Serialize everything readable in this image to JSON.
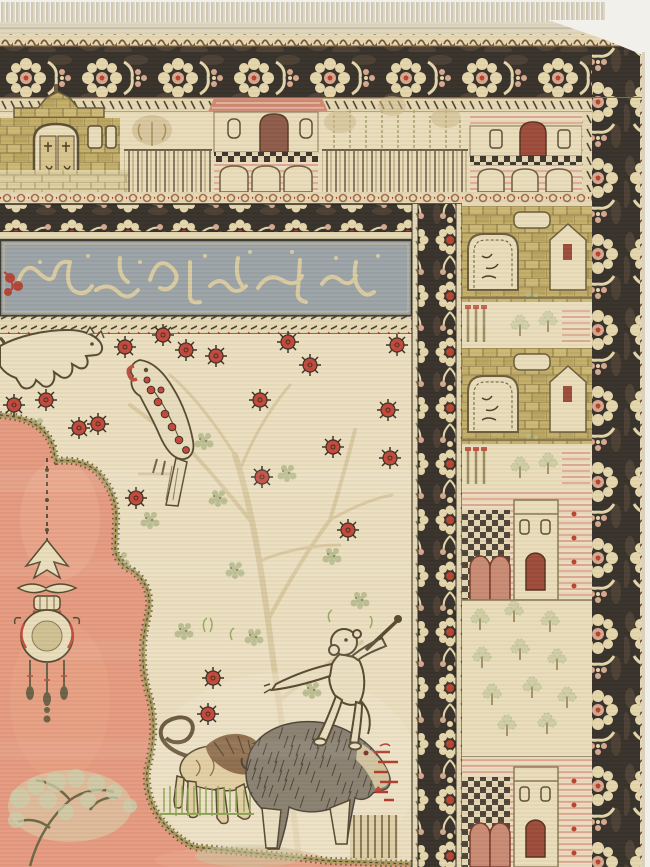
{
  "image_type": "photograph",
  "subject": "Antique Anatolian pictorial prayer rug, upper-right corner view: knotted fringe, charcoal palmette borders, architectural friezes of buildings, slate-grey calligraphic cartouche, and an ivory field with tree of life, red blossoms, salmon medallion with hanging mosque lamp, lion, shaggy boar, club-wielding monkey, perched parrot and leaping feline",
  "palette": {
    "photo_bg": "#f2f0ea",
    "fringe": "#cdc4aa",
    "kilim": "#ded6c0",
    "guard_cream": "#e6d9b4",
    "border_ground": "#35302a",
    "border_mottle": "#6b5640",
    "border_palmette": "#e6d7ac",
    "border_pink": "#d8a88c",
    "border_red": "#b8432f",
    "panel": "#e9ddbb",
    "stone": "#c3ad68",
    "stone_line": "#8a7a4a",
    "roof_pink": "#d08b74",
    "door_brown": "#8d5a49",
    "door_red": "#9c4a38",
    "inscription_ground": "#9ba3a7",
    "inscription_scroll": "#d9cba1",
    "inscription_red": "#b5392c",
    "field": "#ecdfc0",
    "branch": "#cdb88a",
    "leaf": "#b4b98b",
    "blossom": "#c4473a",
    "blossom_outline": "#3c2f24",
    "medallion": "#e59a7f",
    "medallion_edge": "#ab9b5e",
    "lamp_cream": "#e9ddba",
    "lamp_inner": "#cfc192",
    "lamp_red": "#c14c3c",
    "lion_body": "#e2cfa4",
    "lion_mane": "#8a6848",
    "boar_fur": "#8b8172",
    "bristle": "#4c443a",
    "monkey": "#ebdfc2",
    "outline": "#55492f",
    "grass": "#8fa458",
    "signature_red": "#b23a2c"
  },
  "scene": {
    "fringe": {
      "label": "warp-end fringe along top edge"
    },
    "kilim_band": {
      "label": "flatwoven end band"
    },
    "borders": {
      "outer_floral": {
        "label": "charcoal palmette-and-rosette main border, top and right"
      },
      "rosette_band": {
        "label": "narrow charcoal rosette border framing the field"
      },
      "inner_vertical": {
        "label": "rosette border between field and building panel"
      },
      "s_guard": {
        "label": "S-motif guard stripe at outer edge"
      },
      "dash_guards": {
        "label": "reciprocal dashed guard stripes"
      }
    },
    "inscription": {
      "label": "calligraphic cartouche band",
      "script": "stylized Ottoman calligraphy, illegible",
      "ground": "slate blue-grey",
      "accent": "red floral sprig at left end"
    },
    "architecture_frieze": {
      "label": "upper panel with a row of buildings",
      "buildings": [
        "khaki stone house with stepped gable and arched double door",
        "fenced garden with weeping tree",
        "pink-roofed villa over a checkered arched terrace",
        "cypress grove behind a picket fence",
        "arcaded house with pink-hatched sky"
      ]
    },
    "right_panel": {
      "label": "vertical panel of stacked buildings and gardens",
      "motifs": [
        "stone gateway with pointed gable and red niche",
        "red-capped colonnettes and cypresses",
        "second stone gateway",
        "checkered arcade and tower with red door",
        "walled garden of shrubs",
        "lower tower with red door"
      ],
      "garden_trees": [
        [
          18,
          20
        ],
        [
          52,
          12
        ],
        [
          88,
          22
        ],
        [
          20,
          58
        ],
        [
          58,
          50
        ],
        [
          95,
          60
        ],
        [
          30,
          95
        ],
        [
          70,
          88
        ],
        [
          105,
          98
        ],
        [
          45,
          126
        ],
        [
          85,
          124
        ]
      ]
    },
    "field": {
      "label": "ivory field with tree of life, blossoms and animals",
      "medallion": {
        "label": "salmon lobed corner medallion with hanging mosque lamp and flowering sage tree"
      },
      "animals": [
        {
          "name": "leaping-feline",
          "desc": "outlined feline leaping at top left"
        },
        {
          "name": "parrot",
          "desc": "perched bird of prey with red-spotted plumage and hooked red beak"
        },
        {
          "name": "lion",
          "desc": "small maned lion with looped tail and blossom on its back"
        },
        {
          "name": "boar",
          "desc": "large shaggy bristled boar"
        },
        {
          "name": "monkey",
          "desc": "monkey standing on the boar brandishing a club"
        }
      ],
      "signature": {
        "label": "red woven marks beside the monkey",
        "color": "#b23a2c"
      },
      "blossoms": [
        [
          125,
          347
        ],
        [
          163,
          335
        ],
        [
          186,
          350
        ],
        [
          216,
          356
        ],
        [
          288,
          342
        ],
        [
          397,
          345
        ],
        [
          310,
          365
        ],
        [
          14,
          405
        ],
        [
          46,
          400
        ],
        [
          79,
          428
        ],
        [
          98,
          424
        ],
        [
          260,
          400
        ],
        [
          388,
          410
        ],
        [
          333,
          447
        ],
        [
          390,
          458
        ],
        [
          262,
          477
        ],
        [
          136,
          498
        ],
        [
          348,
          530
        ],
        [
          213,
          678
        ],
        [
          208,
          714
        ]
      ],
      "leaf_clusters": [
        [
          36,
          426
        ],
        [
          204,
          441
        ],
        [
          287,
          473
        ],
        [
          150,
          520
        ],
        [
          235,
          570
        ],
        [
          332,
          556
        ],
        [
          184,
          631
        ],
        [
          254,
          637
        ],
        [
          312,
          690
        ],
        [
          218,
          498
        ],
        [
          360,
          600
        ],
        [
          120,
          560
        ]
      ]
    }
  }
}
